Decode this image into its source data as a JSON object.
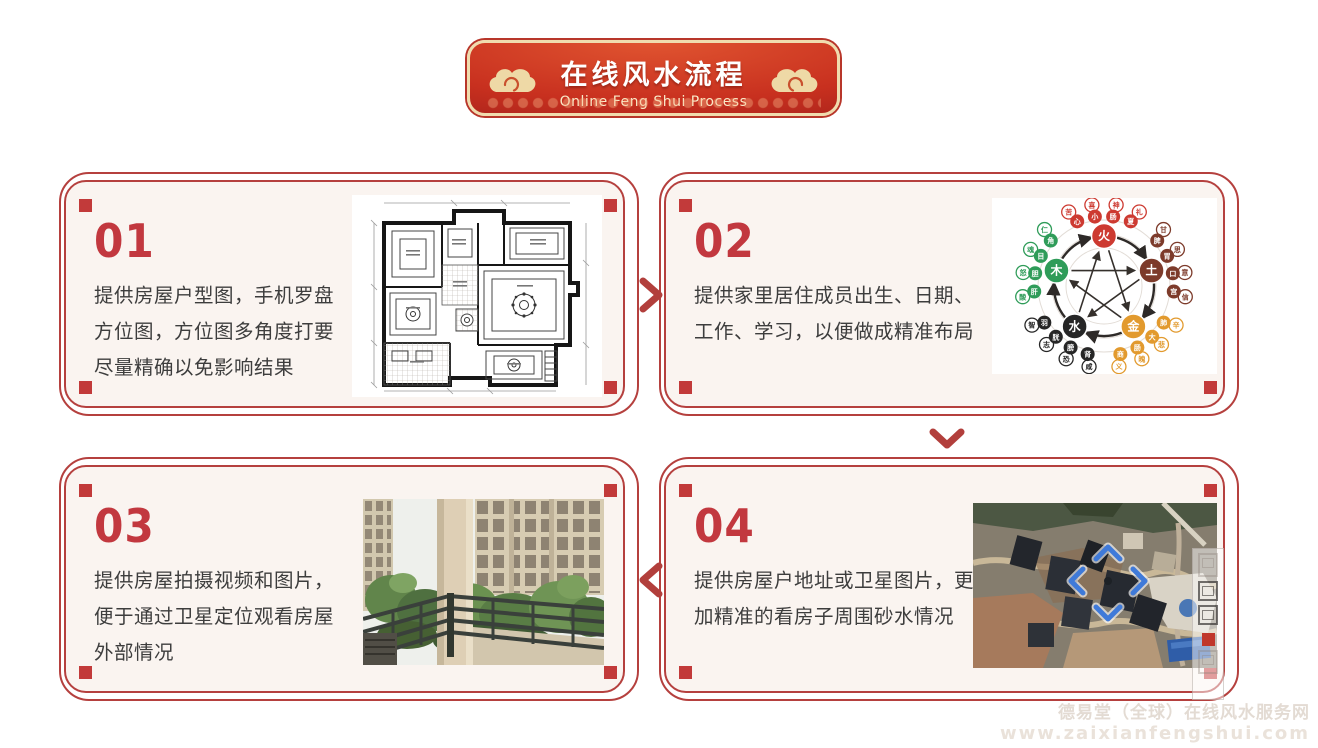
{
  "banner": {
    "title": "在线风水流程",
    "subtitle": "Online Feng Shui Process"
  },
  "steps": [
    {
      "number": "01",
      "lines": [
        "提供房屋户型图，手机罗盘",
        "方位图，方位图多角度打要",
        "尽量精确以免影响结果"
      ],
      "image": "floor-plan"
    },
    {
      "number": "02",
      "lines": [
        "提供家里居住成员出生、日期、",
        "工作、学习，以便做成精准布局"
      ],
      "image": "five-elements-diagram"
    },
    {
      "number": "03",
      "lines": [
        "提供房屋拍摄视频和图片，",
        "便于通过卫星定位观看房屋",
        "外部情况"
      ],
      "image": "balcony-photo"
    },
    {
      "number": "04",
      "lines": [
        "提供房屋户地址或卫星图片，更",
        "加精准的看房子周围砂水情况"
      ],
      "image": "satellite-photo"
    }
  ],
  "flow": {
    "arrow_1_to_2": "chevron-right",
    "arrow_2_to_4": "chevron-down",
    "arrow_4_to_3": "chevron-left"
  },
  "five_elements": {
    "center": {
      "cx": 112,
      "cy": 88,
      "node_radius": 50,
      "rings": [
        38,
        52,
        66
      ]
    },
    "elements": [
      {
        "label": "火",
        "color": "#cd3a31",
        "angle": -90,
        "outer_chars": [
          "苦",
          "喜",
          "神",
          "礼"
        ],
        "inner_chars": [
          "心",
          "小",
          "肠",
          "夏"
        ]
      },
      {
        "label": "土",
        "color": "#7d3b2b",
        "angle": -18,
        "outer_chars": [
          "甘",
          "思",
          "意",
          "信"
        ],
        "inner_chars": [
          "脾",
          "胃",
          "口",
          "宫"
        ]
      },
      {
        "label": "金",
        "color": "#e29a2e",
        "angle": 54,
        "outer_chars": [
          "辛",
          "悲",
          "魄",
          "义"
        ],
        "inner_chars": [
          "肺",
          "大",
          "肠",
          "商"
        ]
      },
      {
        "label": "水",
        "color": "#262626",
        "angle": 126,
        "outer_chars": [
          "咸",
          "恐",
          "志",
          "智"
        ],
        "inner_chars": [
          "肾",
          "膀",
          "胱",
          "羽"
        ]
      },
      {
        "label": "木",
        "color": "#2f9c59",
        "angle": 198,
        "outer_chars": [
          "酸",
          "怒",
          "魂",
          "仁"
        ],
        "inner_chars": [
          "肝",
          "胆",
          "目",
          "角"
        ]
      }
    ]
  },
  "footer": {
    "line1": "德易堂（全球）在线风水服务网",
    "line2": "www.zaixianfengshui.com"
  },
  "colors": {
    "card_border": "#b5403e",
    "corner_square": "#c23a3a",
    "step_number": "#c2383f",
    "body_text": "#3d3d3d",
    "card_bg": "#faf4f0",
    "banner_red_top": "#e05430",
    "banner_red_bottom": "#9c1d1a",
    "banner_trim": "#f0dcae",
    "arrow": "#b23f3c",
    "watermark_text": "#e3dbd3"
  }
}
